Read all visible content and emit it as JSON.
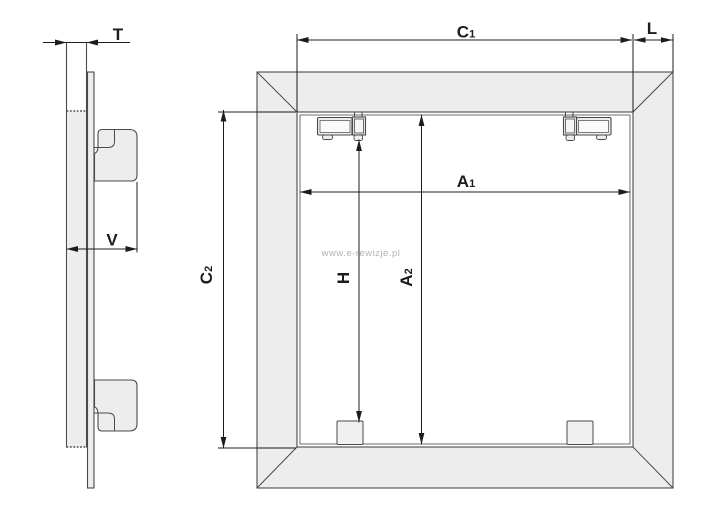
{
  "diagram": {
    "title": "access-panel-dimension-drawing",
    "watermark": "www.e-rewizje.pl",
    "side_view": {
      "dim_t": "T",
      "dim_v": "V"
    },
    "front_view": {
      "dim_c1_letter": "C",
      "dim_c1_sub": "1",
      "dim_l": "L",
      "dim_a1_letter": "A",
      "dim_a1_sub": "1",
      "dim_c2_letter": "C",
      "dim_c2_sub": "2",
      "dim_h": "H",
      "dim_a2_letter": "A",
      "dim_a2_sub": "2"
    },
    "colors": {
      "edge_line": "#4a4a4a",
      "dimension_line": "#1c1c1c",
      "panel_fill": "#ededed",
      "inner_fill": "#ffffff",
      "watermark": "#b4b2b2"
    }
  }
}
